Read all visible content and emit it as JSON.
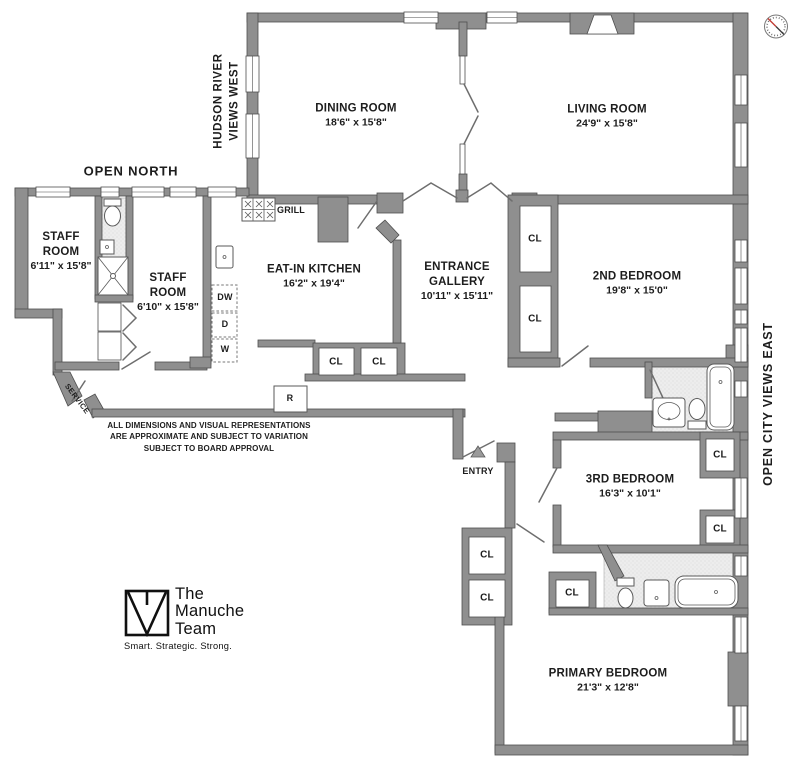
{
  "colors": {
    "wall": "#8f8f8f",
    "wall_outline": "#4e4e4e",
    "bath_floor": "#ededed",
    "text": "#1d1d1d",
    "logo": "#101010",
    "compass_needle": "#c23b33",
    "fixture_outline": "#5a5a5a"
  },
  "orientation": {
    "north": "OPEN NORTH",
    "west_line1": "HUDSON RIVER",
    "west_line2": "VIEWS WEST",
    "east": "OPEN CITY VIEWS EAST",
    "compass": "compass-icon"
  },
  "rooms": {
    "dining": {
      "name": "DINING ROOM",
      "dims": "18'6\" x 15'8\""
    },
    "living": {
      "name": "LIVING ROOM",
      "dims": "24'9\" x 15'8\""
    },
    "staff_room_1": {
      "name_line1": "STAFF",
      "name_line2": "ROOM",
      "dims": "6'11\" x 15'8\""
    },
    "staff_room_2": {
      "name_line1": "STAFF",
      "name_line2": "ROOM",
      "dims": "6'10\" x 15'8\""
    },
    "kitchen": {
      "name": "EAT-IN KITCHEN",
      "dims": "16'2\" x 19'4\""
    },
    "gallery": {
      "name_line1": "ENTRANCE",
      "name_line2": "GALLERY",
      "dims": "10'11\" x 15'11\""
    },
    "bed2": {
      "name": "2ND BEDROOM",
      "dims": "19'8\" x 15'0\""
    },
    "bed3": {
      "name": "3RD BEDROOM",
      "dims": "16'3\" x 10'1\""
    },
    "primary": {
      "name": "PRIMARY BEDROOM",
      "dims": "21'3\" x 12'8\""
    }
  },
  "labels": {
    "closet": "CL",
    "grill": "GRILL",
    "dishwasher": "DW",
    "dryer": "D",
    "washer": "W",
    "refrigerator": "R",
    "service": "SERVICE",
    "entry": "ENTRY"
  },
  "disclaimer": {
    "line1": "ALL DIMENSIONS AND VISUAL REPRESENTATIONS",
    "line2": "ARE APPROXIMATE AND SUBJECT TO VARIATION",
    "line3": "SUBJECT TO BOARD APPROVAL"
  },
  "branding": {
    "line1": "The",
    "line2": "Manuche",
    "line3": "Team",
    "tagline": "Smart. Strategic. Strong."
  }
}
